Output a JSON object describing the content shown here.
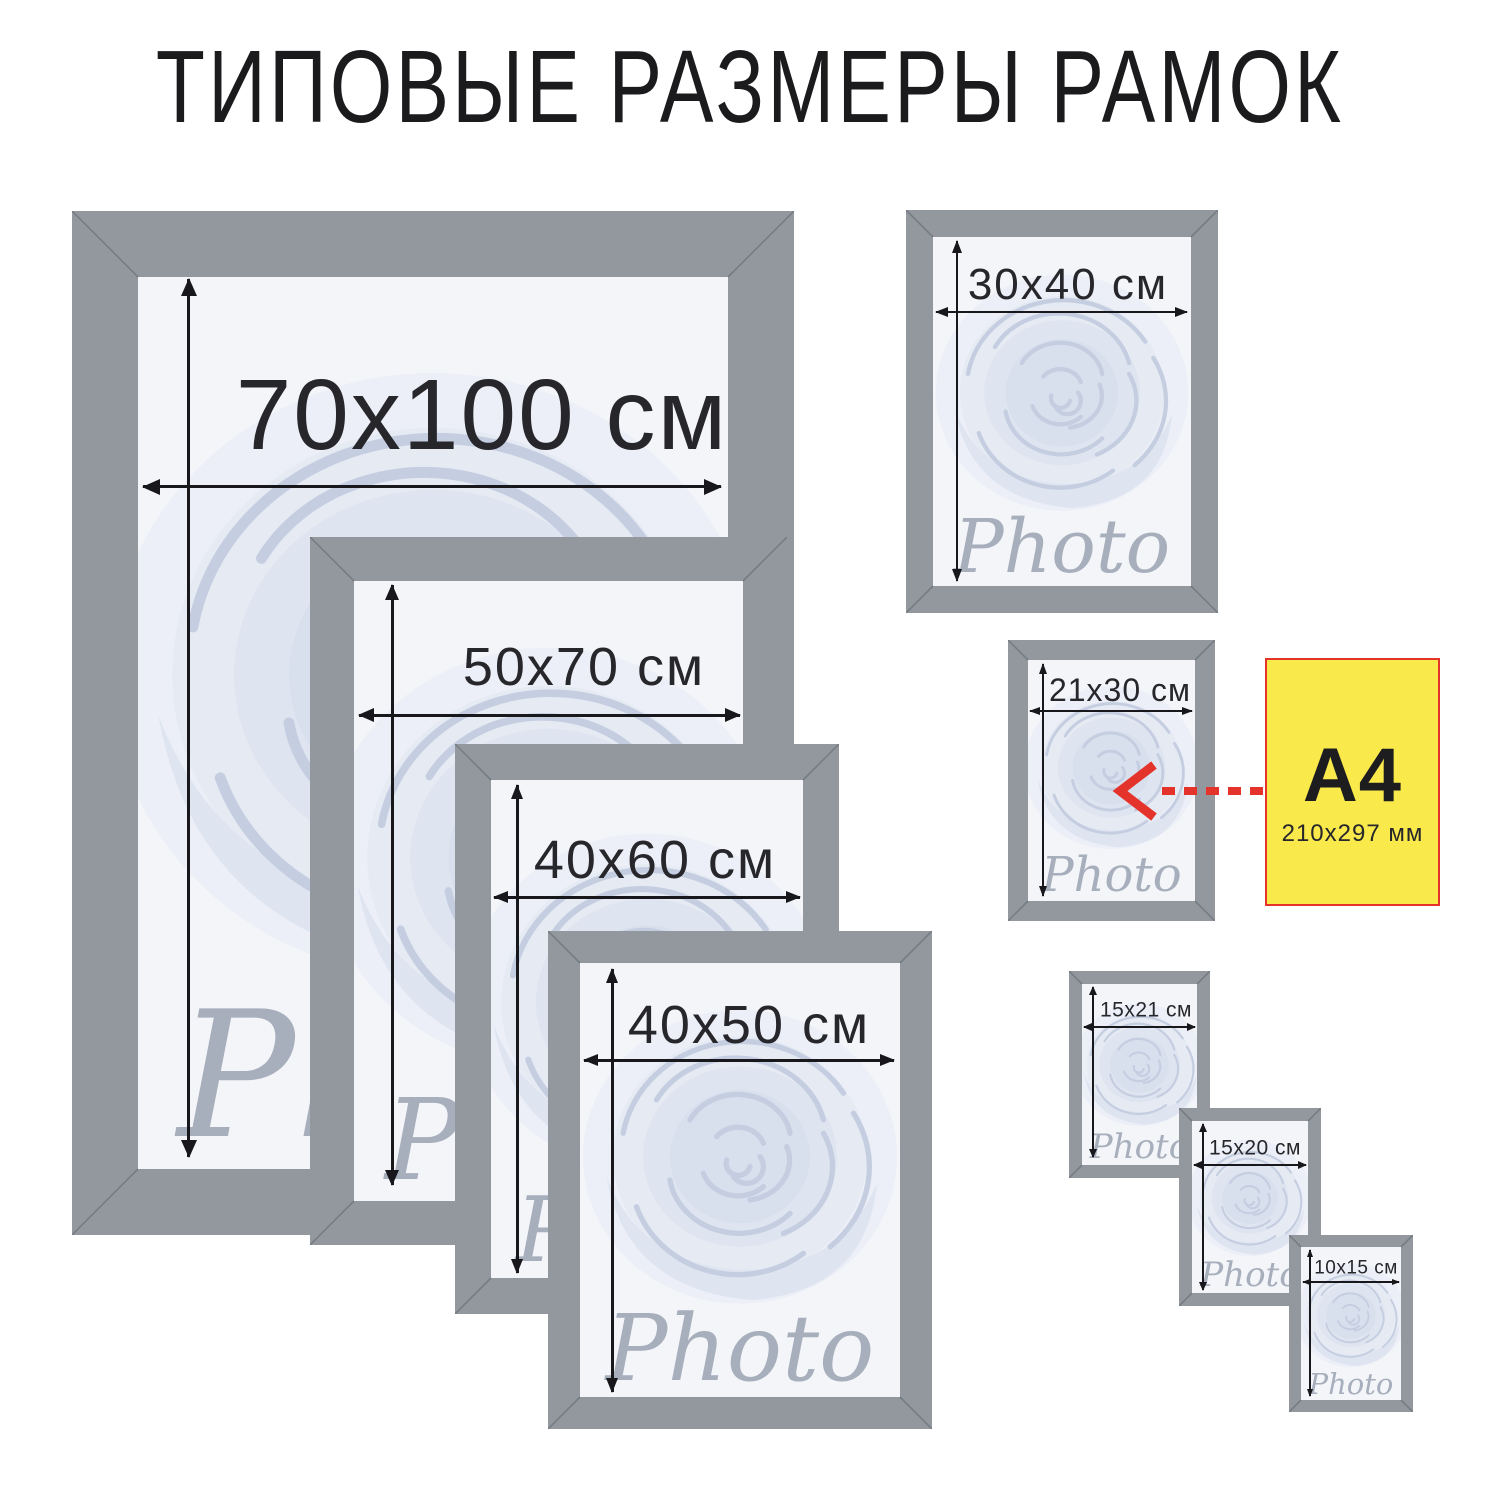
{
  "title": "ТИПОВЫЕ РАЗМЕРЫ РАМОК",
  "watermark": "Photo",
  "colors": {
    "frame_gray": "#92989d",
    "mat_white": "#f3f5f8",
    "accent_red": "#e4332a",
    "a4_yellow": "#f9e94b",
    "text_dark": "#26262b"
  },
  "frames": [
    {
      "id": "70x100",
      "label": "70x100 см"
    },
    {
      "id": "50x70",
      "label": "50x70 см"
    },
    {
      "id": "40x60",
      "label": "40x60 см"
    },
    {
      "id": "40x50",
      "label": "40x50 см"
    },
    {
      "id": "30x40",
      "label": "30x40 см"
    },
    {
      "id": "21x30",
      "label": "21x30 см"
    },
    {
      "id": "15x21",
      "label": "15x21 см"
    },
    {
      "id": "15x20",
      "label": "15x20 см"
    },
    {
      "id": "10x15",
      "label": "10x15 см"
    }
  ],
  "a4_note": {
    "title": "A4",
    "subtitle": "210x297 мм"
  }
}
